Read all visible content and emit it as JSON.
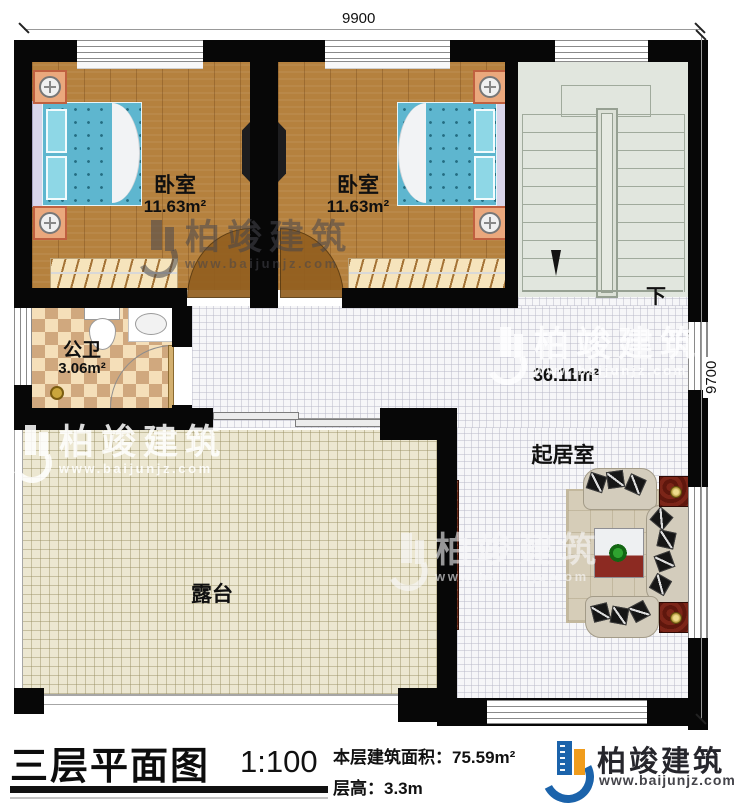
{
  "plan": {
    "dimensions": {
      "top": "9900",
      "right": "9700"
    },
    "rooms": {
      "bedroom_left": {
        "name": "卧室",
        "area": "11.63m²"
      },
      "bedroom_right": {
        "name": "卧室",
        "area": "11.63m²"
      },
      "bathroom": {
        "name": "公卫",
        "area": "3.06m²"
      },
      "living_room": {
        "name": "起居室",
        "area": "36.11m²"
      },
      "terrace": {
        "name": "露台"
      },
      "stairs": {
        "direction_label": "下"
      }
    }
  },
  "watermark": {
    "brand": "柏竣建筑",
    "url": "www.baijunjz.com"
  },
  "footer": {
    "title": "三层平面图",
    "scale": "1:100",
    "area_label": "本层建筑面积：",
    "area_value": "75.59m²",
    "floor_height_label": "层高：",
    "floor_height_value": "3.3m",
    "brand": "柏竣建筑",
    "brand_url": "www.baijunjz.com"
  },
  "colors": {
    "wall": "#070707",
    "brand_blue": "#1b63ab",
    "brand_orange": "#f09c1c",
    "wood_floor": "#b5813e",
    "bed_blue": "#5eb6cf",
    "terrace_tile": "#ece7d1",
    "stair_floor": "#e1e6de"
  }
}
